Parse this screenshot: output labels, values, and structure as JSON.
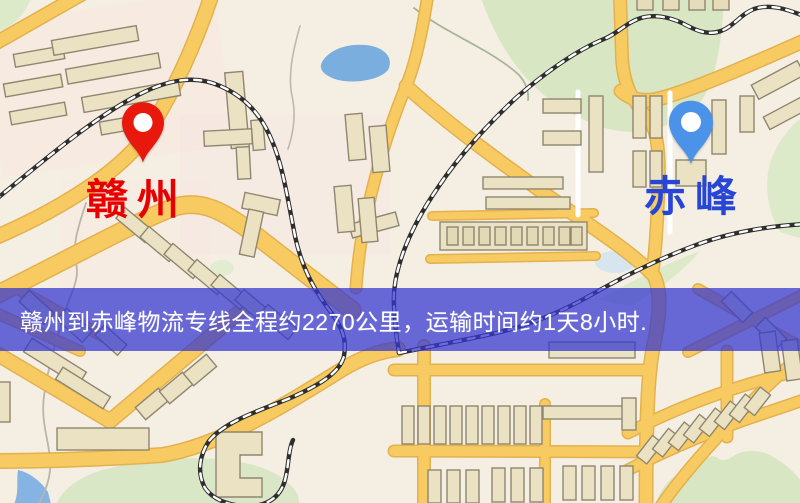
{
  "map": {
    "origin_label": "赣州",
    "destination_label": "赤峰",
    "origin_pin_color": "#e9180c",
    "destination_pin_color": "#4b93e8",
    "origin_label_color": "#e80000",
    "destination_label_color": "#2746d6"
  },
  "banner": {
    "text": "赣州到赤峰物流专线全程约2270公里，运输时间约1天8小时.",
    "background_color": "#3537d0",
    "text_color": "#ffffff"
  },
  "route": {
    "origin": "赣州",
    "destination": "赤峰",
    "service": "物流专线",
    "distance_text": "约2270公里",
    "duration_text": "约1天8小时"
  },
  "map_colors": {
    "background": "#f5efe3",
    "road": "#f7cb61",
    "road_casing": "#e3b14e",
    "building_fill": "#ebe2c4",
    "building_stroke": "#8f8670",
    "green_area": "#d9e7c6",
    "water": "#7aaede",
    "railway": "#2e2e2e"
  }
}
